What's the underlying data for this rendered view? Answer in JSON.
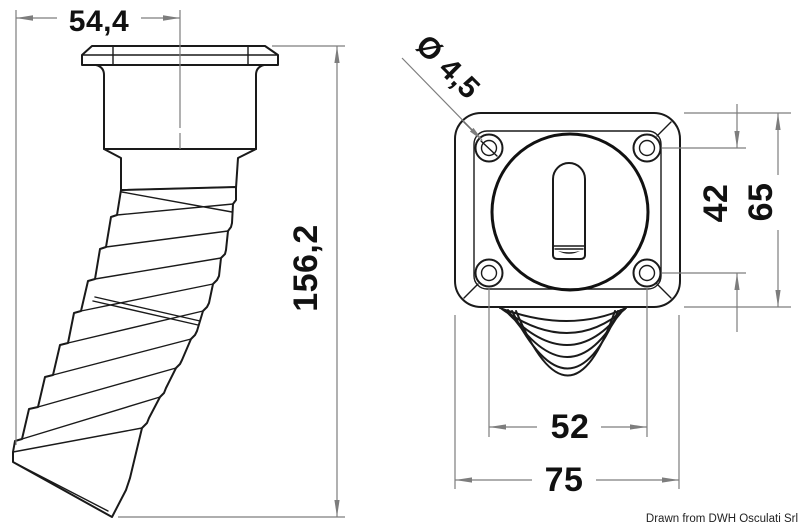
{
  "drawing": {
    "type": "technical-drawing",
    "subject": "deck fill / vent fitting with corrugated hose, side view and front flange view",
    "credit": "Drawn from DWH Osculati Srl",
    "dimensions": {
      "hose_horizontal_offset": "54,4",
      "total_height": "156,2",
      "screw_hole_diameter": "Ø 4,5",
      "hole_spacing_vertical": "42",
      "flange_height": "65",
      "hole_spacing_horizontal": "52",
      "flange_width": "75"
    },
    "colors": {
      "line": "#1a1a1a",
      "dimension": "#7d7d7d",
      "background": "#ffffff",
      "text": "#111111"
    }
  }
}
